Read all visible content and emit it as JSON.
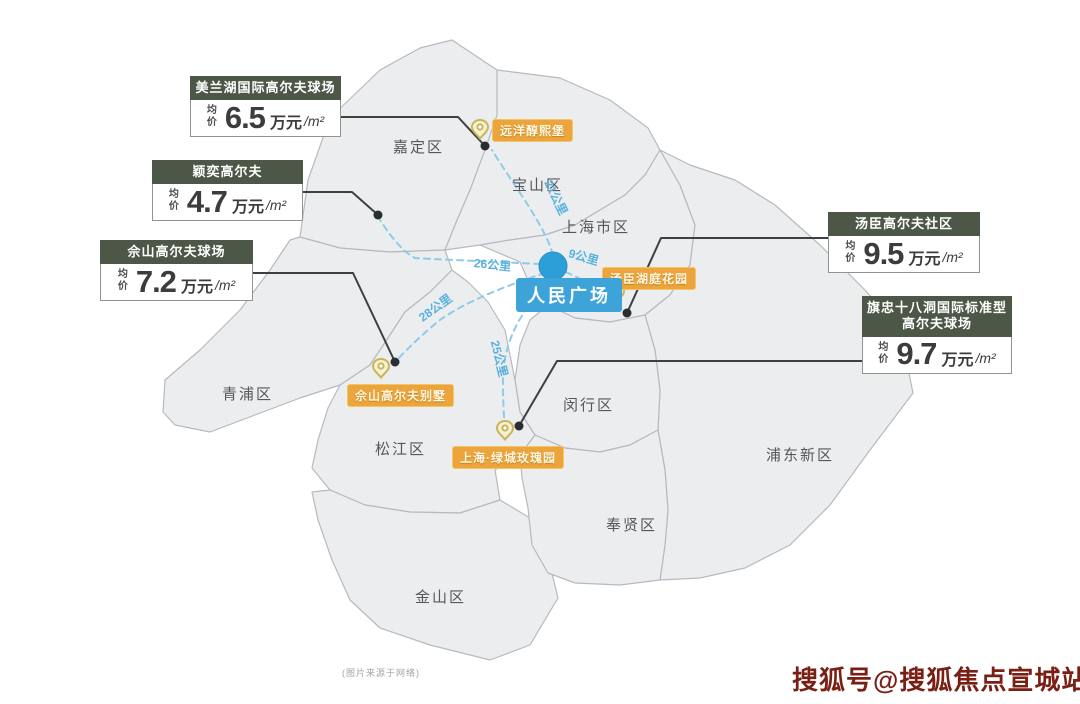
{
  "colors": {
    "callout_header_bg": "#4d5747",
    "poi_label_bg": "#eca53d",
    "center_label_bg": "#3da3d9",
    "route_blue": "#8ecbe9",
    "map_fill": "#ebedef",
    "map_stroke": "#b6bac0",
    "watermark_color": "#7a1f14"
  },
  "callouts": [
    {
      "title": "美兰湖国际高尔夫球场",
      "avg_label": "均价",
      "value": "6.5",
      "unit": "万元",
      "per": "/m²"
    },
    {
      "title": "颖奕高尔夫",
      "avg_label": "均价",
      "value": "4.7",
      "unit": "万元",
      "per": "/m²"
    },
    {
      "title": "佘山高尔夫球场",
      "avg_label": "均价",
      "value": "7.2",
      "unit": "万元",
      "per": "/m²"
    },
    {
      "title": "汤臣高尔夫社区",
      "avg_label": "均价",
      "value": "9.5",
      "unit": "万元",
      "per": "/m²"
    },
    {
      "title": "旗忠十八洞国际标准型高尔夫球场",
      "avg_label": "均价",
      "value": "9.7",
      "unit": "万元",
      "per": "/m²"
    }
  ],
  "districts": [
    {
      "name": "嘉定区"
    },
    {
      "name": "宝山区"
    },
    {
      "name": "上海市区"
    },
    {
      "name": "青浦区"
    },
    {
      "name": "松江区"
    },
    {
      "name": "闵行区"
    },
    {
      "name": "浦东新区"
    },
    {
      "name": "奉贤区"
    },
    {
      "name": "金山区"
    }
  ],
  "pois": [
    {
      "name": "远洋醇熙堡"
    },
    {
      "name": "汤臣湖庭花园"
    },
    {
      "name": "佘山高尔夫别墅"
    },
    {
      "name": "上海·绿城玫瑰园"
    }
  ],
  "center_poi": {
    "name": "人民广场"
  },
  "distances": [
    {
      "label": "21公里"
    },
    {
      "label": "9公里"
    },
    {
      "label": "26公里"
    },
    {
      "label": "28公里"
    },
    {
      "label": "25公里"
    }
  ],
  "footer": {
    "source_note": "(图片来源于网络)",
    "watermark": "搜狐号@搜狐焦点宣城站"
  }
}
